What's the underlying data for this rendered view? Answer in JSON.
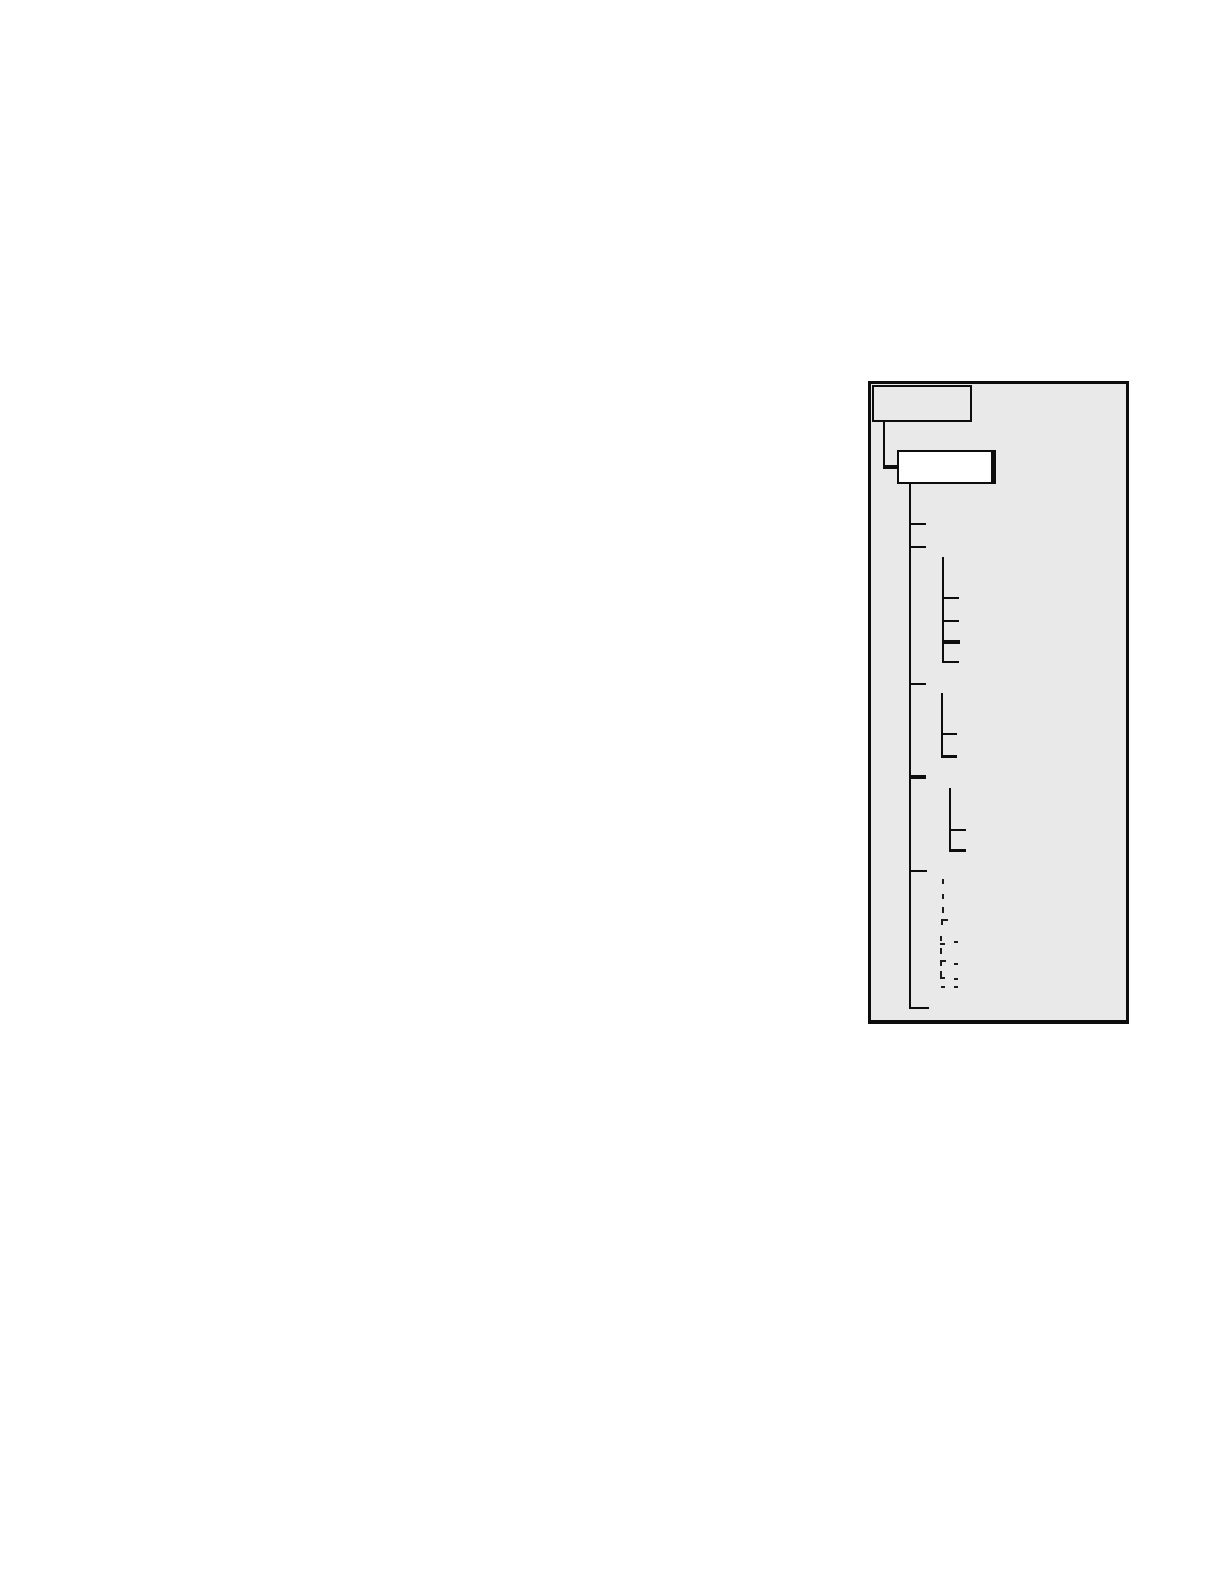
{
  "page": {
    "width": 1224,
    "height": 1584,
    "background": "#ffffff"
  },
  "figure": {
    "description": "tree-diagram-figure-with-two-empty-nodes-and-branch-lines",
    "colors": {
      "panel_fill": "#e9e9e9",
      "panel_border": "#0d0d0d",
      "line": "#0d0d0d",
      "root_box_fill": "#e9e9e9",
      "child_box_fill": "#ffffff",
      "mark": "#1c1c1c"
    },
    "panel": {
      "x": 868,
      "y": 381,
      "w": 261,
      "h": 643,
      "border_w": 3,
      "border_bottom_w": 4
    },
    "boxes": [
      {
        "name": "root-node-box",
        "label": "",
        "x": 872,
        "y": 385,
        "w": 100,
        "h": 37,
        "fill": "#e9e9e9",
        "border_w": 2,
        "border_right_w": 2
      },
      {
        "name": "child-node-box",
        "label": "",
        "x": 897,
        "y": 450,
        "w": 99,
        "h": 34,
        "fill": "#ffffff",
        "border_w": 2,
        "border_right_w": 5
      }
    ],
    "lines": [
      {
        "name": "elbow-vertical",
        "x": 883,
        "y": 422,
        "w": 2,
        "h": 46
      },
      {
        "name": "elbow-horizontal-thick",
        "x": 883,
        "y": 465,
        "w": 15,
        "h": 4
      },
      {
        "name": "trunk-vertical",
        "x": 909,
        "y": 484,
        "w": 2,
        "h": 525
      },
      {
        "name": "trunk-foot",
        "x": 909,
        "y": 1007,
        "w": 20,
        "h": 2
      },
      {
        "name": "trunk-tick-1",
        "x": 909,
        "y": 523,
        "w": 17,
        "h": 2
      },
      {
        "name": "trunk-tick-2",
        "x": 909,
        "y": 546,
        "w": 17,
        "h": 2
      },
      {
        "name": "trunk-tick-3",
        "x": 909,
        "y": 683,
        "w": 17,
        "h": 2
      },
      {
        "name": "trunk-tick-4-thick",
        "x": 909,
        "y": 775,
        "w": 17,
        "h": 4
      },
      {
        "name": "trunk-tick-5",
        "x": 909,
        "y": 870,
        "w": 18,
        "h": 2
      },
      {
        "name": "branch1-vertical",
        "x": 942,
        "y": 557,
        "w": 2,
        "h": 106
      },
      {
        "name": "branch1-tick-1",
        "x": 942,
        "y": 597,
        "w": 17,
        "h": 2
      },
      {
        "name": "branch1-tick-2",
        "x": 942,
        "y": 620,
        "w": 17,
        "h": 2
      },
      {
        "name": "branch1-tick-3-thick",
        "x": 942,
        "y": 640,
        "w": 18,
        "h": 4
      },
      {
        "name": "branch1-foot",
        "x": 942,
        "y": 661,
        "w": 17,
        "h": 2
      },
      {
        "name": "branch2-vertical",
        "x": 941,
        "y": 693,
        "w": 2,
        "h": 65
      },
      {
        "name": "branch2-tick-1",
        "x": 941,
        "y": 733,
        "w": 16,
        "h": 2
      },
      {
        "name": "branch2-foot-thick",
        "x": 941,
        "y": 755,
        "w": 16,
        "h": 3
      },
      {
        "name": "branch3-vertical",
        "x": 949,
        "y": 788,
        "w": 2,
        "h": 63
      },
      {
        "name": "branch3-tick-1",
        "x": 949,
        "y": 829,
        "w": 17,
        "h": 2
      },
      {
        "name": "branch3-foot",
        "x": 949,
        "y": 849,
        "w": 17,
        "h": 3
      }
    ],
    "marks": [
      {
        "name": "tiny-mark",
        "x": 942,
        "y": 879,
        "w": 2,
        "h": 5
      },
      {
        "name": "tiny-mark",
        "x": 942,
        "y": 894,
        "w": 2,
        "h": 5
      },
      {
        "name": "tiny-mark",
        "x": 942,
        "y": 907,
        "w": 2,
        "h": 6
      },
      {
        "name": "tiny-mark",
        "x": 941,
        "y": 919,
        "w": 7,
        "h": 2
      },
      {
        "name": "tiny-mark",
        "x": 941,
        "y": 919,
        "w": 2,
        "h": 6
      },
      {
        "name": "tiny-mark",
        "x": 940,
        "y": 936,
        "w": 2,
        "h": 5
      },
      {
        "name": "tiny-mark",
        "x": 940,
        "y": 943,
        "w": 5,
        "h": 2
      },
      {
        "name": "tiny-mark",
        "x": 954,
        "y": 941,
        "w": 4,
        "h": 2
      },
      {
        "name": "tiny-mark",
        "x": 940,
        "y": 948,
        "w": 2,
        "h": 6
      },
      {
        "name": "tiny-mark",
        "x": 940,
        "y": 960,
        "w": 6,
        "h": 2
      },
      {
        "name": "tiny-mark",
        "x": 940,
        "y": 960,
        "w": 2,
        "h": 6
      },
      {
        "name": "tiny-mark",
        "x": 954,
        "y": 963,
        "w": 4,
        "h": 2
      },
      {
        "name": "tiny-mark",
        "x": 940,
        "y": 971,
        "w": 2,
        "h": 8
      },
      {
        "name": "tiny-mark",
        "x": 940,
        "y": 977,
        "w": 5,
        "h": 2
      },
      {
        "name": "tiny-mark",
        "x": 954,
        "y": 978,
        "w": 4,
        "h": 2
      },
      {
        "name": "tiny-mark",
        "x": 941,
        "y": 986,
        "w": 4,
        "h": 2
      },
      {
        "name": "tiny-mark",
        "x": 954,
        "y": 986,
        "w": 4,
        "h": 2
      }
    ],
    "structure_summary": {
      "type": "tree",
      "root_nodes": 1,
      "child_nodes": 1,
      "trunk_tick_count": 5,
      "emphasized_trunk_tick_index": 3,
      "sub_branches": [
        {
          "ticks": 4,
          "emphasized_tick_index": 2
        },
        {
          "ticks": 2,
          "emphasized_tick_index": 1
        },
        {
          "ticks": 2,
          "emphasized_tick_index": 1
        }
      ]
    }
  }
}
